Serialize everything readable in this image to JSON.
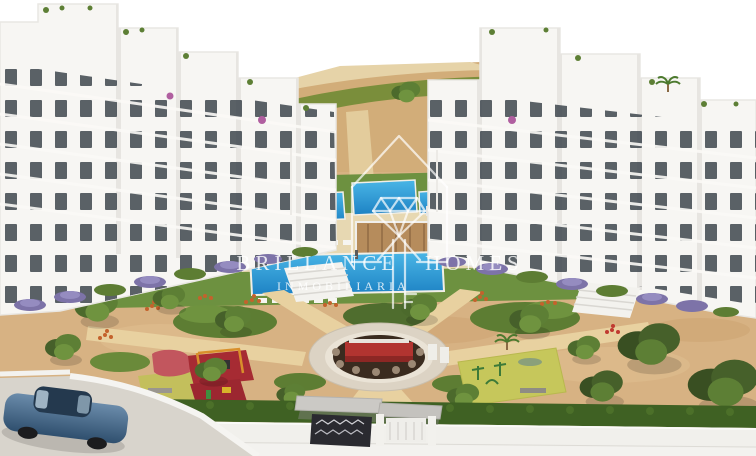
{
  "watermark": {
    "brand_word1": "BRILLANCE",
    "brand_word2": "HOMES",
    "subtitle": "INMOBILIARIA",
    "logo_icon": "house-outline-with-diamond"
  },
  "palette": {
    "sky": "#ffffff",
    "building_white": "#f7f6f3",
    "building_shadow": "#e7e5e1",
    "window_dark": "#3e464e",
    "sand": "#d7b283",
    "light_sand": "#e6cf9e",
    "lawn_green": "#6d9140",
    "hill_green": "#7a8e3b",
    "hedge_green": "#3f6123",
    "pool_blue_light": "#4ab6e6",
    "pool_blue_dark": "#1d82c4",
    "pool_deck_beige": "#e7d8b2",
    "wood_deck": "#b68c5c",
    "playground_red": "#a62b33",
    "slide_pink_red": "#c2565e",
    "swing_frame_orange": "#d98f2b",
    "gym_mat_yellow_green": "#c6c75b",
    "flower_orange": "#c4622c",
    "shrub_purple": "#7d73a8",
    "road_grey": "#d8d4cc",
    "wall_white": "#f1f0ec",
    "plaza_dark_brown": "#3a2b1f",
    "plaza_red": "#b23430",
    "car_blue": "#4a688a",
    "watermark_white": "rgba(255,255,255,0.75)"
  },
  "scene_objects": [
    "left-apartment-building",
    "right-apartment-building",
    "communal-lawn",
    "upper-swimming-pools",
    "main-swimming-pool",
    "sun-loungers",
    "wooden-pool-deck",
    "pool-house",
    "palm-trees",
    "sandy-garden",
    "radiating-garden-paths",
    "central-circular-plaza",
    "red-seating-pavilion",
    "children-playground",
    "swing-set",
    "slide",
    "outdoor-gym",
    "fitness-equipment",
    "garden-bench",
    "perimeter-hedge",
    "perimeter-wall",
    "entrance-gate",
    "access-road",
    "parked-blue-car",
    "mediterranean-trees",
    "orange-flowering-shrubs",
    "purple-flowering-shrubs",
    "lamp-posts",
    "stairs"
  ]
}
